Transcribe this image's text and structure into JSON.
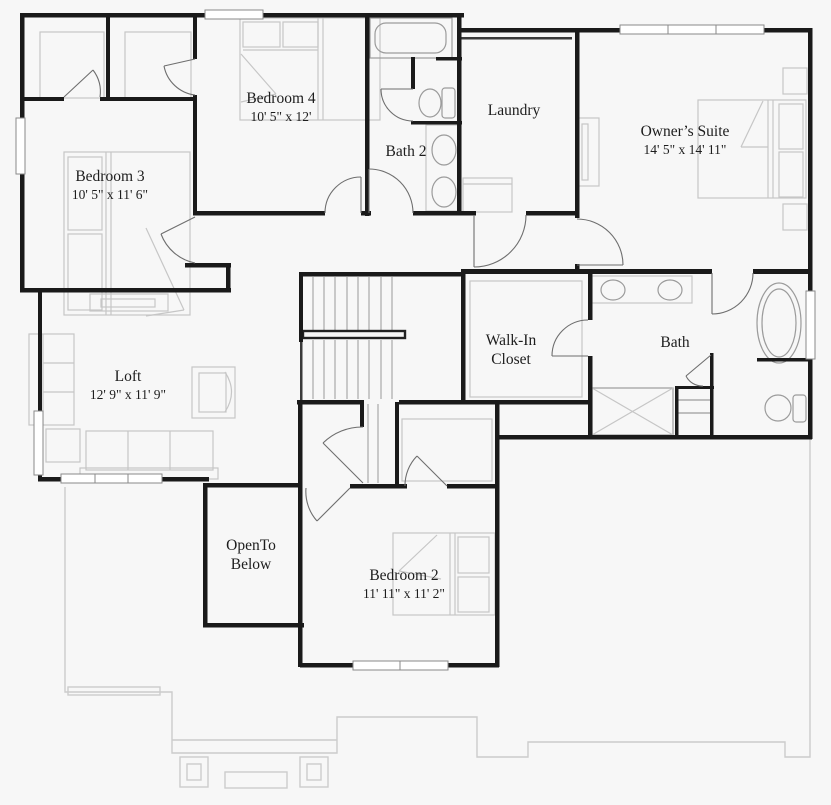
{
  "colors": {
    "background": "#f7f7f7",
    "wall": "#1a1a1a",
    "furniture_outline": "#c6c6c6",
    "fixture_outline": "#9b9b9b",
    "door_arc": "#6e6e6e",
    "lower_floor_outline": "#cccccc",
    "text": "#1d1d1d"
  },
  "rooms": [
    {
      "id": "bedroom-3",
      "name": "Bedroom 3",
      "dims": "10' 5\" x 11' 6\""
    },
    {
      "id": "bedroom-4",
      "name": "Bedroom 4",
      "dims": "10' 5\" x 12'"
    },
    {
      "id": "bath-2",
      "name": "Bath 2",
      "dims": ""
    },
    {
      "id": "laundry",
      "name": "Laundry",
      "dims": ""
    },
    {
      "id": "owners-suite",
      "name": "Owner’s Suite",
      "dims": "14' 5\" x 14' 11\""
    },
    {
      "id": "loft",
      "name": "Loft",
      "dims": "12' 9\" x 11' 9\""
    },
    {
      "id": "walk-in-closet",
      "name": "Walk-In",
      "name2": "Closet",
      "dims": ""
    },
    {
      "id": "bath",
      "name": "Bath",
      "dims": ""
    },
    {
      "id": "open-to-below",
      "name": "OpenTo",
      "name2": "Below",
      "dims": ""
    },
    {
      "id": "bedroom-2",
      "name": "Bedroom 2",
      "dims": "11' 11\" x 11' 2\""
    }
  ]
}
